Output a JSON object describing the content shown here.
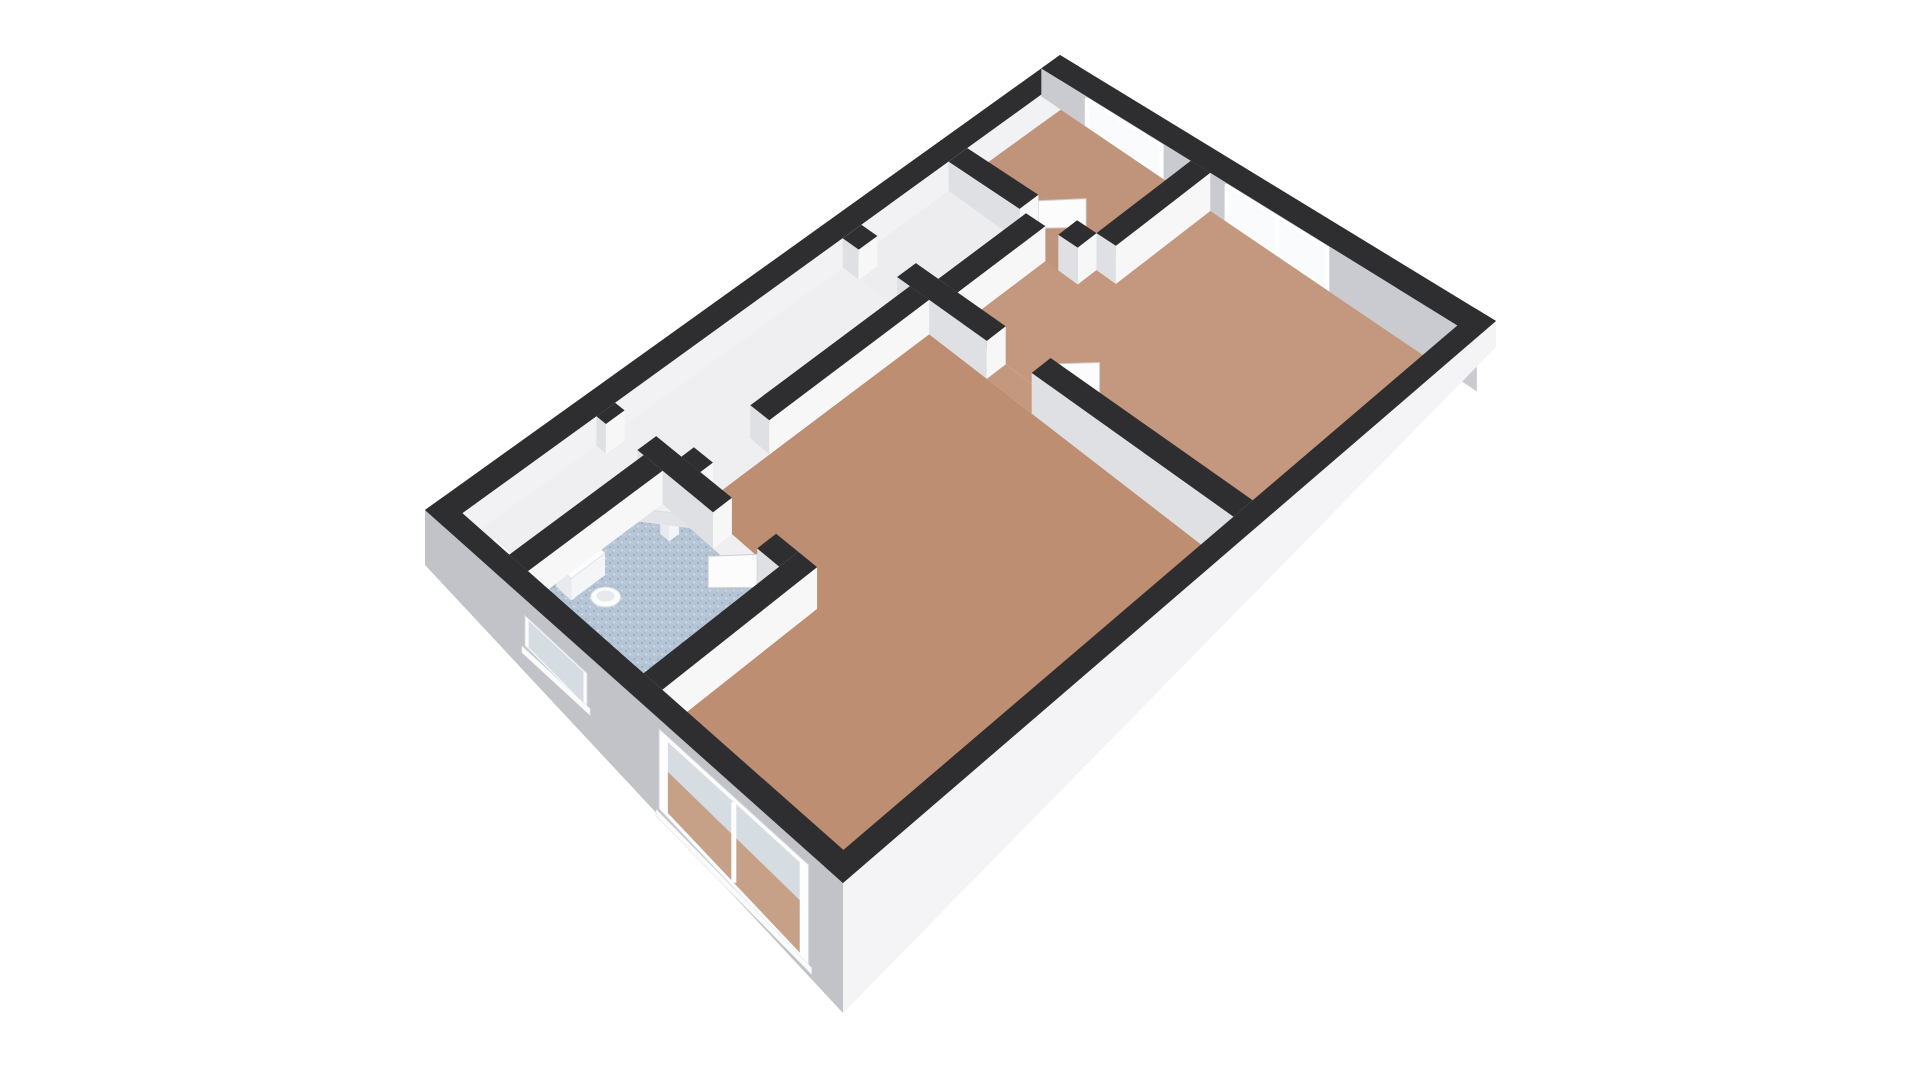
{
  "scene": {
    "canvas": {
      "w": 1920,
      "h": 1080,
      "background": "#ffffff"
    },
    "projection": {
      "quad": {
        "W": [
          425,
          510
        ],
        "N": [
          1060,
          55
        ],
        "E": [
          1496,
          321
        ],
        "S": [
          843,
          883
        ]
      },
      "plan_w": 10.2,
      "plan_d": 6.7,
      "wall_h_base": 28,
      "wall_h_slope": 26
    },
    "colors": {
      "wall_top": "#2e2e31",
      "face_v": "#f7f7f8",
      "face_u": "#dfe0e3",
      "nw_inner": "#f2f2f4",
      "ne_inner": "#c9cbd0",
      "sw_facade": "#c2c3c8",
      "se_facade": "#f4f4f6",
      "frame": "#ffffff",
      "glass_ne": "#fafbfc",
      "glass_sw": "#d5dce2",
      "glass_reveal": "#d3d6da",
      "floor_through": "#c59a7d",
      "floor_living": "#bd8e71",
      "floor_bedroom": "#c3987e",
      "floor_small_bedroom": "#c0947a",
      "floor_hall": "#efeff1",
      "floor_closet": "#ededef",
      "bath_tile": "#b5c5d5",
      "bath_dot_dark": "#96abc0",
      "bath_dot_light": "#dde5ec",
      "fixture_white": "#fbfcfd",
      "fixture_side": "#e9eaed",
      "fixture_front": "#f4f5f7",
      "door_panel": "#fcfcfd",
      "door_edge": "#cdced2"
    },
    "rooms": [
      {
        "name": "hall",
        "rect": [
          0.3,
          0.3,
          2.45,
          1.05
        ],
        "floor": "floor_hall"
      },
      {
        "name": "bathroom",
        "rect": [
          0.3,
          1.35,
          2.45,
          3.2
        ],
        "floor": "bath_tile",
        "speckle": true
      },
      {
        "name": "corridor",
        "rect": [
          2.75,
          0.3,
          6.4,
          1.35
        ],
        "floor": "floor_hall"
      },
      {
        "name": "closet",
        "rect": [
          6.7,
          0.3,
          8.1,
          1.5
        ],
        "floor": "floor_closet"
      },
      {
        "name": "small-bedroom",
        "rect": [
          8.4,
          0.3,
          9.9,
          2.3
        ],
        "floor": "floor_small_bedroom"
      },
      {
        "name": "bedroom",
        "poly": [
          [
            6.7,
            1.8
          ],
          [
            8.1,
            1.8
          ],
          [
            8.1,
            1.4
          ],
          [
            8.4,
            1.4
          ],
          [
            8.4,
            2.6
          ],
          [
            9.9,
            2.6
          ],
          [
            9.9,
            6.4
          ],
          [
            6.7,
            6.4
          ]
        ],
        "floor": "floor_bedroom"
      },
      {
        "name": "living-room",
        "poly": [
          [
            2.75,
            1.65
          ],
          [
            6.4,
            1.65
          ],
          [
            6.4,
            6.4
          ],
          [
            0.3,
            6.4
          ],
          [
            0.3,
            3.5
          ],
          [
            2.75,
            3.5
          ]
        ],
        "floor": "floor_living"
      },
      {
        "name": "threshold-hall",
        "rect": [
          2.45,
          0.45,
          2.75,
          0.95
        ],
        "floor": "floor_hall"
      },
      {
        "name": "threshold-bathroom",
        "rect": [
          2.45,
          2.15,
          2.75,
          2.85
        ],
        "floor": "floor_hall"
      },
      {
        "name": "threshold-living",
        "rect": [
          2.95,
          1.35,
          3.85,
          1.65
        ],
        "floor": "floor_hall"
      },
      {
        "name": "threshold-closet",
        "rect": [
          6.4,
          0.55,
          6.7,
          1.15
        ],
        "floor": "floor_closet"
      },
      {
        "name": "threshold-bedroom",
        "rect": [
          6.4,
          2.55,
          6.7,
          3.25
        ],
        "floor": "floor_bedroom"
      },
      {
        "name": "threshold-small-bedroom",
        "rect": [
          8.1,
          1.4,
          8.4,
          2.0
        ],
        "floor": "floor_small_bedroom"
      }
    ],
    "walls": [
      [
        0.3,
        1.05,
        2.45,
        1.35
      ],
      [
        0.3,
        3.2,
        2.75,
        3.5
      ],
      [
        2.45,
        0.3,
        2.75,
        0.45
      ],
      [
        2.45,
        0.95,
        2.75,
        2.15
      ],
      [
        2.45,
        2.85,
        2.75,
        3.2
      ],
      [
        2.75,
        1.35,
        2.95,
        1.65
      ],
      [
        3.85,
        1.35,
        6.4,
        1.65
      ],
      [
        6.4,
        0.3,
        6.7,
        0.55
      ],
      [
        6.4,
        1.15,
        6.7,
        2.55
      ],
      [
        6.4,
        3.25,
        6.7,
        6.4
      ],
      [
        6.7,
        1.5,
        8.1,
        1.8
      ],
      [
        8.1,
        0.3,
        8.4,
        1.4
      ],
      [
        8.1,
        2.0,
        8.4,
        2.3
      ],
      [
        8.4,
        2.3,
        9.9,
        2.6
      ]
    ],
    "facades": {
      "nw": {
        "band": [
          0,
          0,
          10.2,
          0.3
        ]
      },
      "ne": {
        "band": [
          9.9,
          0,
          10.2,
          6.7
        ],
        "windows": [
          {
            "name": "small-bedroom-window",
            "v1": 0.7,
            "v2": 1.85,
            "mullion": false
          },
          {
            "name": "bedroom-window",
            "v1": 2.85,
            "v2": 4.4,
            "mullion": true
          }
        ]
      },
      "sw": {
        "band": [
          0,
          0,
          0.3,
          6.7
        ],
        "H0": 55,
        "H1": 130,
        "windows": [
          {
            "name": "bathroom-window",
            "v1": 1.6,
            "v2": 2.6,
            "f1": 0.22,
            "f2": 0.64,
            "mullion": false,
            "through": false
          },
          {
            "name": "living-room-window",
            "v1": 3.75,
            "v2": 6.15,
            "f1": 0.1,
            "f2": 0.93,
            "mullion": true,
            "through": true
          }
        ]
      },
      "se": {
        "band": [
          0,
          6.4,
          10.2,
          6.7
        ],
        "H0": 130,
        "H1": 26
      }
    },
    "fixtures": [
      {
        "type": "prism",
        "name": "toilet-tank",
        "rect": [
          0.72,
          1.38,
          1.26,
          1.62
        ],
        "h": 22
      },
      {
        "type": "bowl",
        "name": "toilet-bowl",
        "at": [
          0.99,
          1.9
        ]
      },
      {
        "type": "prism",
        "name": "washbasin-pedestal",
        "rect": [
          2.14,
          1.62,
          2.3,
          1.76
        ],
        "h": 20
      },
      {
        "type": "basin",
        "name": "corner-washbasin",
        "tri": [
          [
            2.42,
            1.38
          ],
          [
            1.86,
            1.38
          ],
          [
            2.42,
            2.02
          ]
        ],
        "h": 26
      },
      {
        "type": "prism",
        "name": "radiator",
        "rect": [
          0.34,
          0.62,
          0.5,
          1.04
        ],
        "h": 15
      }
    ],
    "doors": [
      {
        "name": "bathroom-door",
        "hinge": [
          2.45,
          2.85
        ],
        "end": [
          2.03,
          2.49
        ]
      },
      {
        "name": "bedroom-door",
        "hinge": [
          6.7,
          3.25
        ],
        "end": [
          7.08,
          3.64
        ]
      },
      {
        "name": "small-bedroom-door",
        "hinge": [
          8.4,
          1.4
        ],
        "end": [
          8.78,
          1.77
        ]
      }
    ]
  }
}
